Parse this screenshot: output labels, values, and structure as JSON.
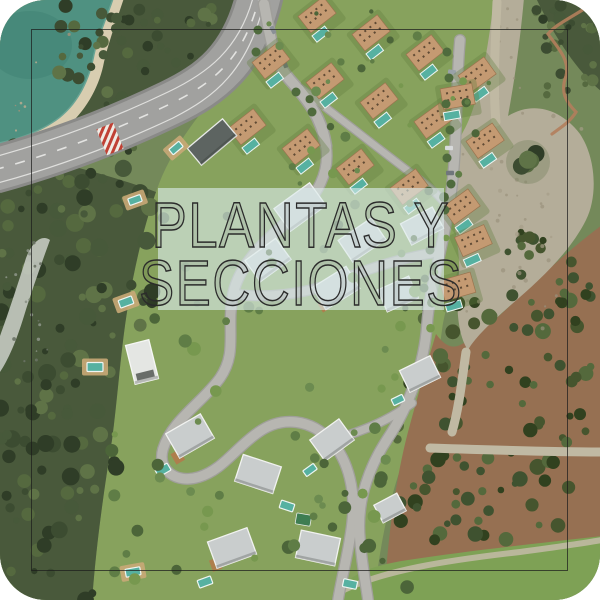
{
  "overlay": {
    "line1": "PLANTAS Y",
    "line2": "SECCIONES"
  },
  "colors": {
    "water": "#4f9181",
    "waterDeep": "#3f8274",
    "sand": "#d8cdb0",
    "forest": "#49593b",
    "lawn": "#87a25d",
    "lawnLight": "#93ad66",
    "lawnBottom": "#7ea155",
    "road": "#a1a19f",
    "roadCasing": "#8a8a88",
    "roadLine": "#efefec",
    "street": "#b7b6b1",
    "streetCasing": "#a09f9b",
    "track": "#c0b9a3",
    "dirt": "#b4ad99",
    "scrub": "#967052",
    "trail": "#b37e5c",
    "rocks": "#cbd0c9",
    "pool": "#56b1a1",
    "poolRim": "#eef5f2",
    "roofTan": "#c49a72",
    "roofTanEdge": "#9a744f",
    "roofGray": "#c9cdcd",
    "roofWhite": "#e4e6e3",
    "roofDark": "#5d6461",
    "deck": "#c9a977",
    "deckDark": "#b07c4c",
    "treeDark": "#3c4c31",
    "treeMid": "#55693f",
    "bush": "#5f7d46",
    "overlayBg": "#dcecec",
    "titleColor": "#2b2b2b",
    "frame": "#1c1c1c",
    "crosswalkRed": "#c23b2e",
    "carGray": "#8a9096"
  }
}
